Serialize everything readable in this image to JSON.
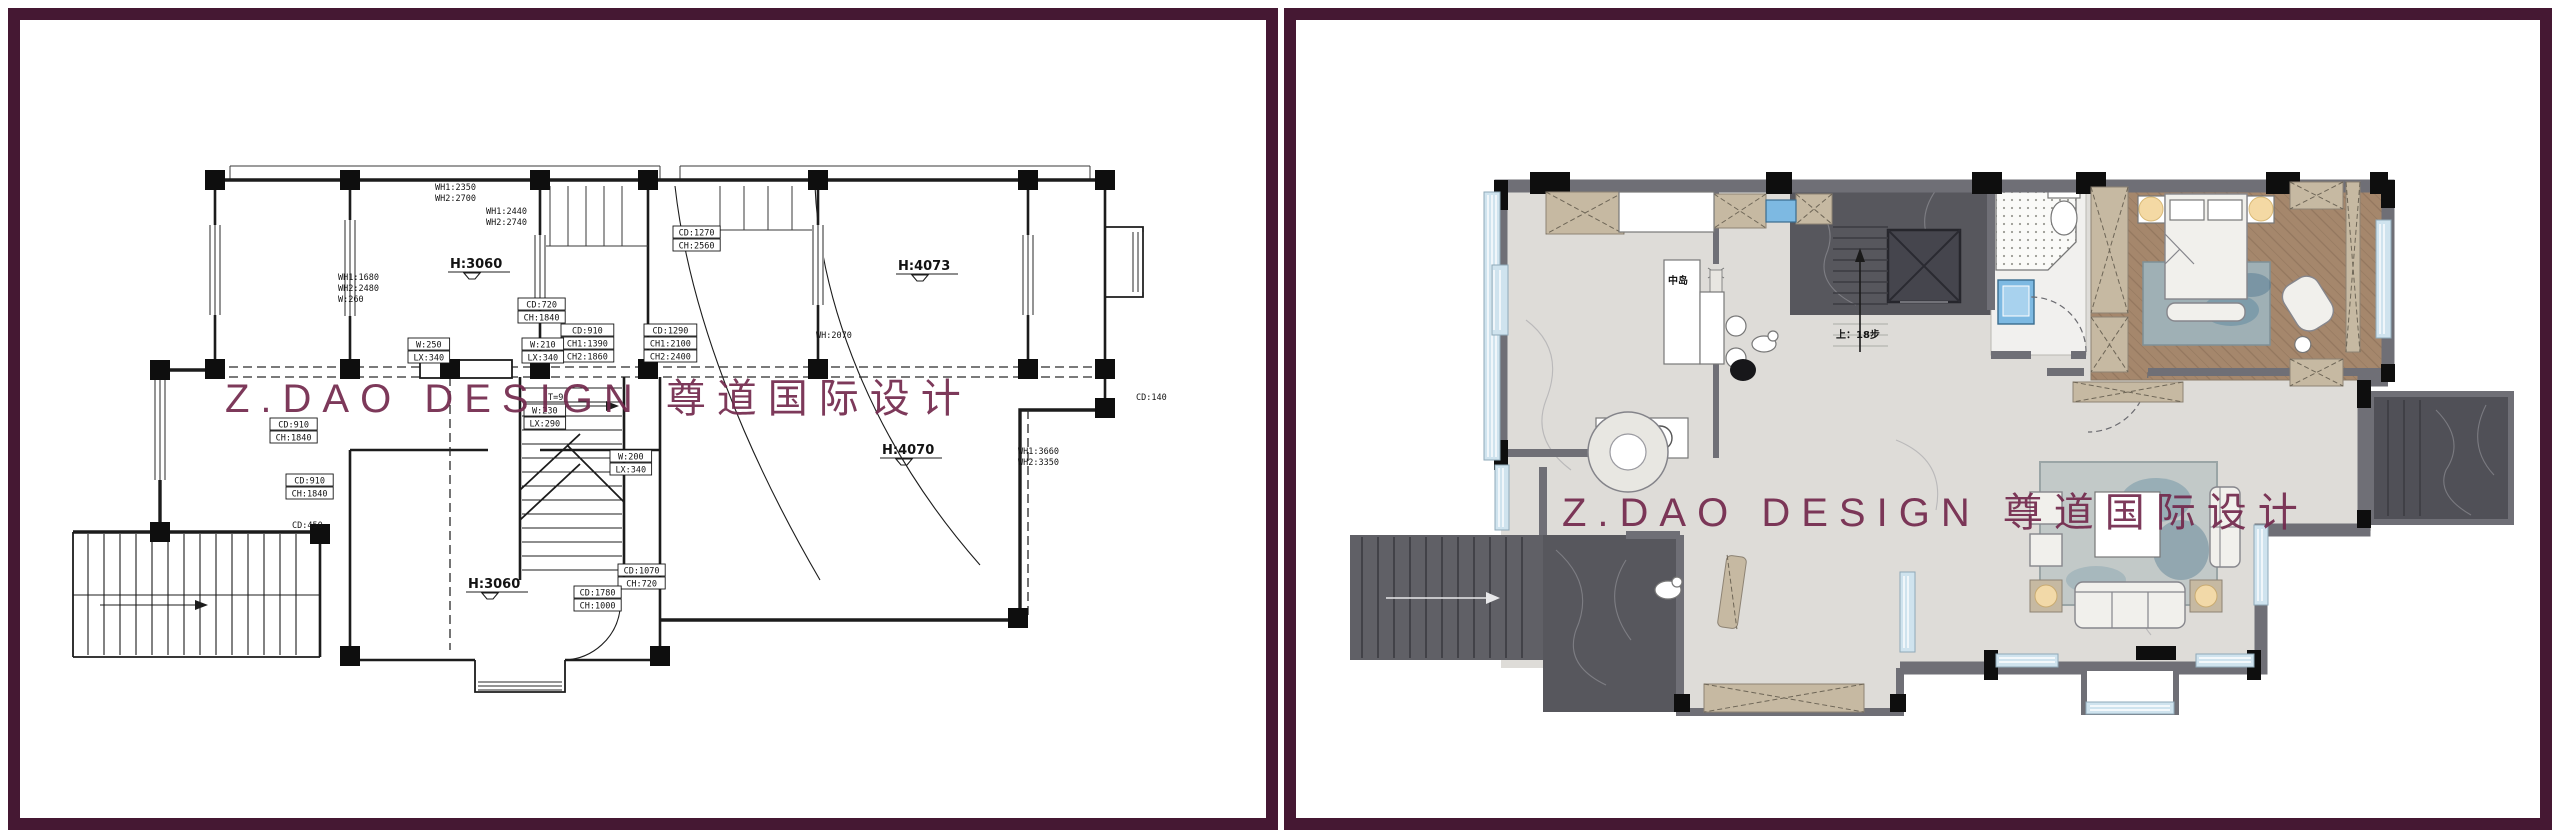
{
  "watermark": {
    "text": "Z.DAO DESIGN 尊道国际设计",
    "color": "#73294d"
  },
  "colors": {
    "frame_border": "#451833",
    "cad_line": "#1c1c1c",
    "wall_gray": "#6f6f76",
    "floor_light": "#dedcd8",
    "floor_dark_marble": "#57575d",
    "wood_floor": "#a5876c",
    "window_blue": "#cfe3ee",
    "cabinet_beige": "#c6b9a2",
    "fixture_blue": "#7db9e2"
  },
  "left_plan": {
    "room_labels": [
      {
        "text": "H:3060",
        "x": 430,
        "y": 248
      },
      {
        "text": "H:4073",
        "x": 878,
        "y": 250
      },
      {
        "text": "H:4070",
        "x": 862,
        "y": 434
      },
      {
        "text": "H:3060",
        "x": 448,
        "y": 568
      }
    ],
    "stair_note": "T=9",
    "annotations": [
      {
        "x": 466,
        "y": 186,
        "box": false,
        "lines": [
          "WH1:2440",
          "WH2:2740"
        ]
      },
      {
        "x": 318,
        "y": 252,
        "box": false,
        "lines": [
          "WH1:1680",
          "WH2:2480",
          "W:260"
        ]
      },
      {
        "x": 498,
        "y": 278,
        "box": true,
        "lines": [
          "CD:720",
          "CH:1840"
        ]
      },
      {
        "x": 541,
        "y": 304,
        "box": true,
        "lines": [
          "CD:910",
          "CH1:1390",
          "CH2:1860"
        ]
      },
      {
        "x": 624,
        "y": 304,
        "box": true,
        "lines": [
          "CD:1290",
          "CH1:2100",
          "CH2:2400"
        ]
      },
      {
        "x": 653,
        "y": 206,
        "box": true,
        "lines": [
          "CD:1270",
          "CH:2560"
        ]
      },
      {
        "x": 388,
        "y": 318,
        "box": true,
        "lines": [
          "W:250",
          "LX:340"
        ]
      },
      {
        "x": 502,
        "y": 318,
        "box": true,
        "lines": [
          "W:210",
          "LX:340"
        ]
      },
      {
        "x": 504,
        "y": 384,
        "box": true,
        "lines": [
          "W:230",
          "LX:290"
        ]
      },
      {
        "x": 250,
        "y": 398,
        "box": true,
        "lines": [
          "CD:910",
          "CH:1840"
        ]
      },
      {
        "x": 266,
        "y": 454,
        "box": true,
        "lines": [
          "CD:910",
          "CH:1840"
        ]
      },
      {
        "x": 272,
        "y": 500,
        "box": false,
        "lines": [
          "CD:450"
        ]
      },
      {
        "x": 590,
        "y": 430,
        "box": true,
        "lines": [
          "W:200",
          "LX:340"
        ]
      },
      {
        "x": 598,
        "y": 544,
        "box": true,
        "lines": [
          "CD:1070",
          "CH:720"
        ]
      },
      {
        "x": 554,
        "y": 566,
        "box": true,
        "lines": [
          "CD:1780",
          "CH:1000"
        ]
      },
      {
        "x": 796,
        "y": 310,
        "box": false,
        "lines": [
          "WH:2070"
        ]
      },
      {
        "x": 998,
        "y": 426,
        "box": false,
        "lines": [
          "WH1:3660",
          "WH2:3350"
        ]
      },
      {
        "x": 1116,
        "y": 372,
        "box": false,
        "lines": [
          "CD:140"
        ]
      },
      {
        "x": 415,
        "y": 162,
        "box": false,
        "lines": [
          "WH1:2350",
          "WH2:2700"
        ]
      }
    ]
  },
  "right_plan": {
    "island_label": "中岛",
    "stair_note": "上：18步",
    "room_labels": [
      {
        "cn": "厨房",
        "en": "Kitchen Rm.",
        "x": 286,
        "y": 248,
        "w": 66,
        "h": 36
      },
      {
        "cn": "卫生间",
        "en": "Bathroom",
        "x": 720,
        "y": 224,
        "w": 70,
        "h": 32
      },
      {
        "cn": "主卧室",
        "en": "Bedroom",
        "x": 876,
        "y": 226,
        "w": 74,
        "h": 34
      },
      {
        "cn": "餐厅",
        "en": "Dining Rm.",
        "x": 304,
        "y": 414,
        "w": 60,
        "h": 34
      },
      {
        "cn": "玄关",
        "en": "Porch",
        "x": 386,
        "y": 550,
        "w": 60,
        "h": 32
      },
      {
        "cn": "客厅",
        "en": "Living Rm.",
        "x": 800,
        "y": 486,
        "w": 60,
        "h": 32
      },
      {
        "cn": "入户区",
        "en": "Main Entrance",
        "x": 956,
        "y": 356,
        "w": 90,
        "h": 32
      }
    ]
  }
}
